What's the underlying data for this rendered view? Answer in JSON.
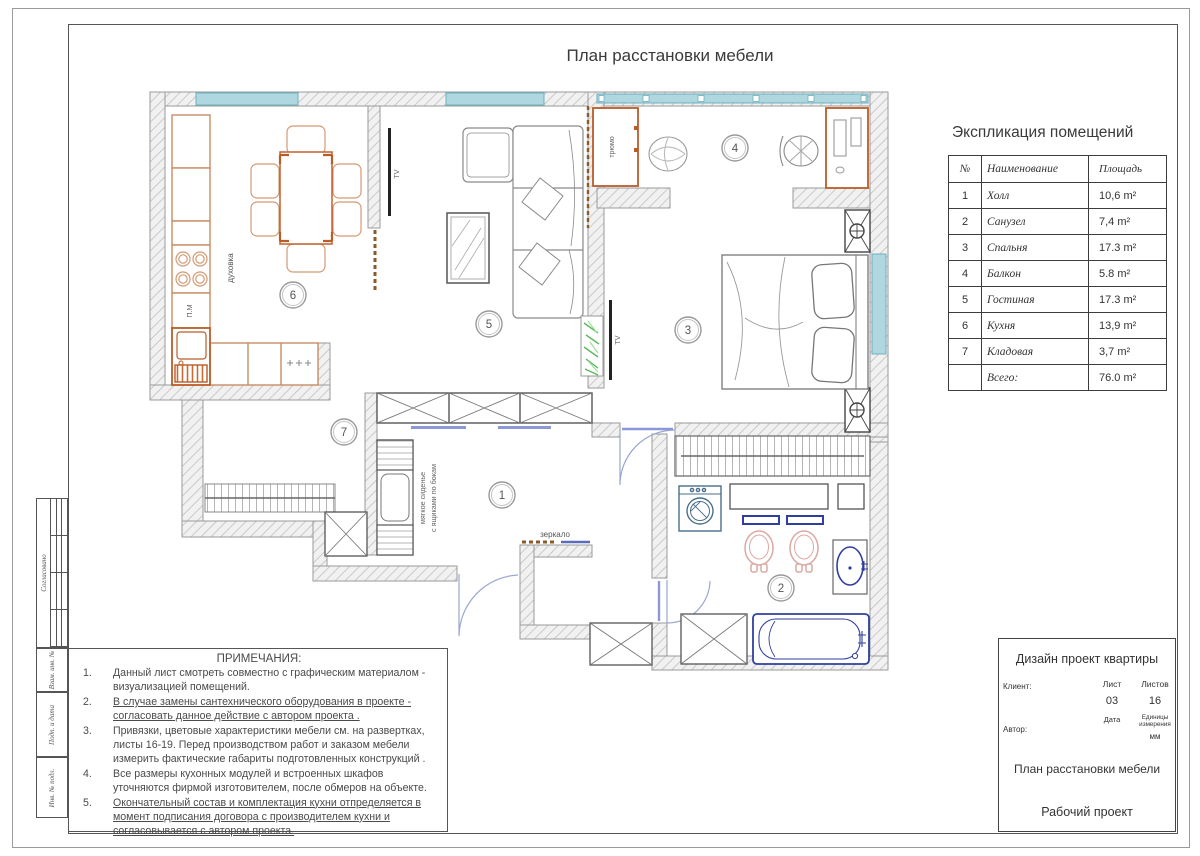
{
  "sheet": {
    "title": "План расстановки мебели",
    "stamp": {
      "approved": "Согласовано",
      "vzam": "Взам. инв. №",
      "podp": "Подп. и дата",
      "inv": "Инв. № подл."
    }
  },
  "explication": {
    "title": "Экспликация помещений",
    "columns": {
      "num": "№",
      "name": "Наименование",
      "area": "Площадь"
    },
    "rows": [
      {
        "num": "1",
        "name": "Холл",
        "area": "10,6 m²"
      },
      {
        "num": "2",
        "name": "Санузел",
        "area": "7,4 m²"
      },
      {
        "num": "3",
        "name": "Спальня",
        "area": "17.3 m²"
      },
      {
        "num": "4",
        "name": "Балкон",
        "area": "5.8 m²"
      },
      {
        "num": "5",
        "name": "Гостиная",
        "area": "17.3 m²"
      },
      {
        "num": "6",
        "name": "Кухня",
        "area": "13,9 m²"
      },
      {
        "num": "7",
        "name": "Кладовая",
        "area": "3,7 m²"
      },
      {
        "num": "",
        "name": "Всего:",
        "area": "76.0 m²"
      }
    ]
  },
  "notes": {
    "title": "ПРИМЕЧАНИЯ:",
    "items": [
      {
        "num": "1.",
        "text": "Данный лист смотреть совместно с графическим материалом - визуализацией помещений."
      },
      {
        "num": "2.",
        "text": "В случае замены сантехнического оборудования в проекте - согласовать данное действие с автором проекта ."
      },
      {
        "num": "3.",
        "text": "Привязки, цветовые характеристики мебели см. на развертках, листы 16-19. Перед производством работ и заказом мебели измерить фактические габариты подготовленных конструкций ."
      },
      {
        "num": "4.",
        "text": "Все размеры кухонных модулей и встроенных шкафов уточняются фирмой изготовителем, после обмеров на объекте."
      },
      {
        "num": "5.",
        "text": "Окончательный состав и комплектация кухни отпределяется в момент подписания договора с производителем кухни и согласовывается с автором проекта."
      }
    ]
  },
  "title_block": {
    "project": "Дизайн проект квартиры",
    "client_label": "Клиент:",
    "author_label": "Автор:",
    "sheet_label": "Лист",
    "sheets_label": "Листов",
    "sheet_number": "03",
    "sheets_total": "16",
    "date_label": "Дата",
    "units_label": "Единицы измерения",
    "units_value": "мм",
    "drawing_title": "План расстановки мебели",
    "stage": "Рабочий проект"
  },
  "plan": {
    "rooms": [
      {
        "number": "1",
        "name": "Холл"
      },
      {
        "number": "2",
        "name": "Санузел"
      },
      {
        "number": "3",
        "name": "Спальня"
      },
      {
        "number": "4",
        "name": "Балкон"
      },
      {
        "number": "5",
        "name": "Гостиная"
      },
      {
        "number": "6",
        "name": "Кухня"
      },
      {
        "number": "7",
        "name": "Кладовая"
      }
    ],
    "labels": {
      "oven": "духовка",
      "dishwasher": "П.М",
      "tv": "TV",
      "dressing_table": "трюмо",
      "mirror": "зеркало",
      "bench_line1": "мягкое сиденье",
      "bench_line2": "с ящиками по бокам"
    },
    "colors": {
      "window": "#aed7e0",
      "furniture_orange": "#b95c28",
      "furniture_orange_light": "#d49a74",
      "plumbing_blue": "#303f9f",
      "sanitary_pink": "#dba8a2",
      "plant_green": "#5cb85c",
      "wall_hatch": "#bdbdbd"
    }
  }
}
